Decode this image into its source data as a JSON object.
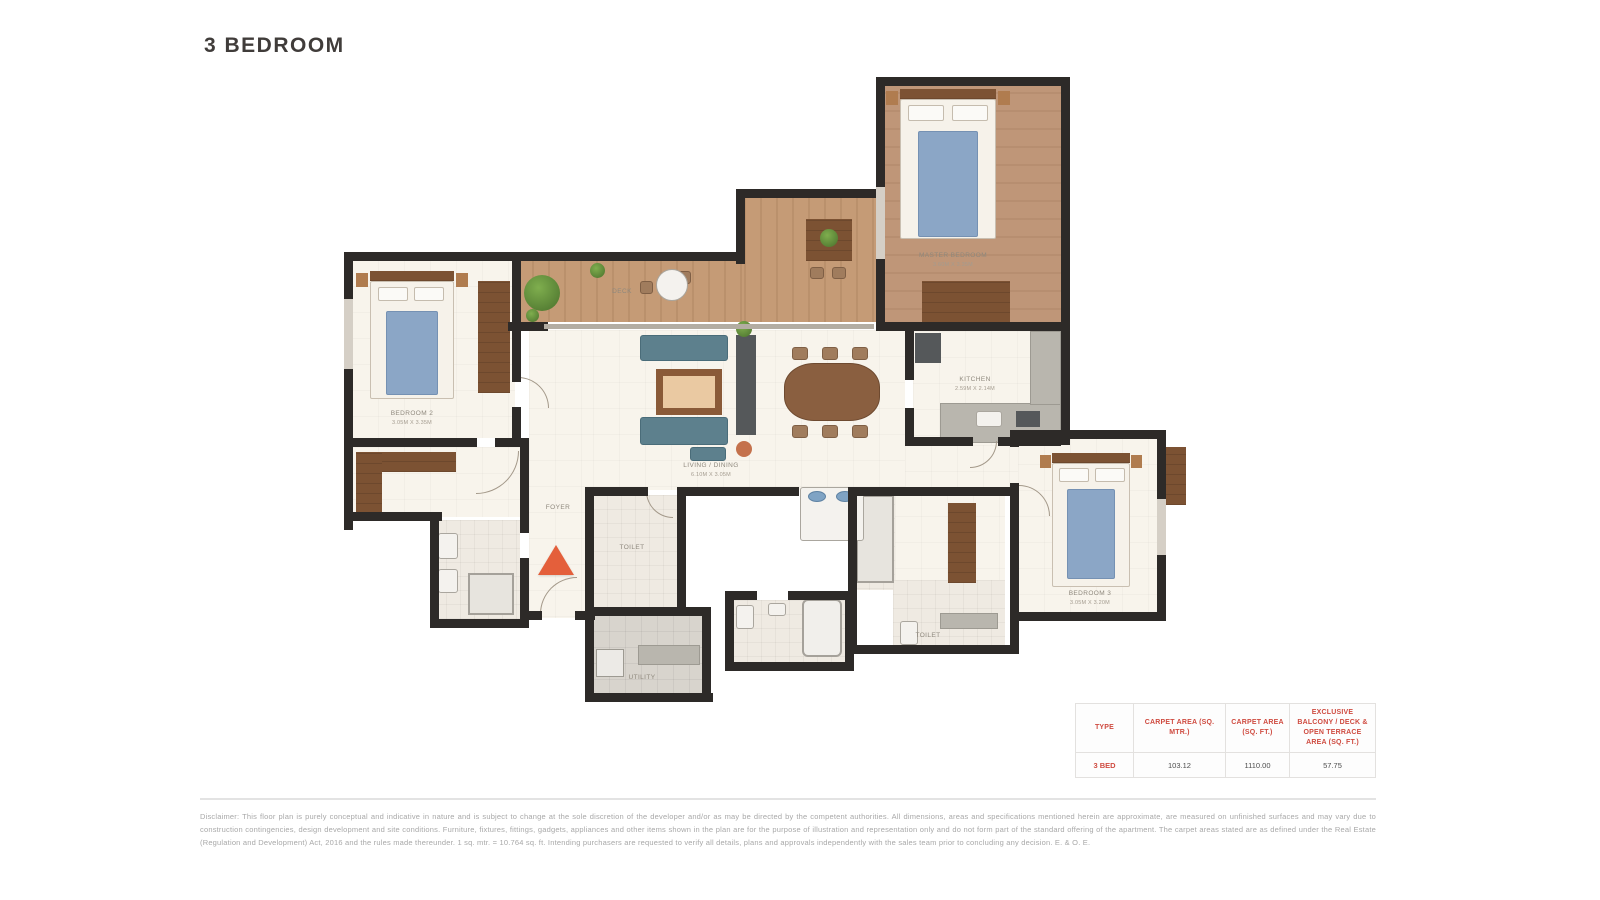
{
  "page": {
    "title": "3 BEDROOM"
  },
  "plan": {
    "rooms": [
      {
        "name": "MASTER BEDROOM",
        "dims": "3.60M X 3.35M"
      },
      {
        "name": "BEDROOM 2",
        "dims": "3.05M X 3.35M"
      },
      {
        "name": "BEDROOM 3",
        "dims": "3.05M X 3.20M"
      },
      {
        "name": "LIVING / DINING",
        "dims": "6.10M X 3.05M"
      },
      {
        "name": "KITCHEN",
        "dims": "2.59M X 2.14M"
      },
      {
        "name": "DECK",
        "dims": ""
      },
      {
        "name": "TOILET",
        "dims": ""
      },
      {
        "name": "TOILET",
        "dims": ""
      },
      {
        "name": "UTILITY",
        "dims": ""
      },
      {
        "name": "FOYER",
        "dims": ""
      }
    ]
  },
  "area_table": {
    "headers": [
      "TYPE",
      "CARPET AREA (SQ. MTR.)",
      "CARPET AREA (SQ. FT.)",
      "EXCLUSIVE BALCONY / DECK & OPEN TERRACE AREA (SQ. FT.)"
    ],
    "row": {
      "type": "3 BED",
      "carpet_sqm": "103.12",
      "carpet_sqft": "1110.00",
      "balcony": "57.75"
    }
  },
  "disclaimer": "Disclaimer: This floor plan is purely conceptual and indicative in nature and is subject to change at the sole discretion of the developer and/or as may be directed by the competent authorities. All dimensions, areas and specifications mentioned herein are approximate, are measured on unfinished surfaces and may vary due to construction contingencies, design development and site conditions. Furniture, fixtures, fittings, gadgets, appliances and other items shown in the plan are for the purpose of illustration and representation only and do not form part of the standard offering of the apartment. The carpet areas stated are as defined under the Real Estate (Regulation and Development) Act, 2016 and the rules made thereunder. 1 sq. mtr. = 10.764 sq. ft. Intending purchasers are requested to verify all details, plans and approvals independently with the sales team prior to concluding any decision. E. & O. E.",
  "colors": {
    "accent_red": "#cf4b40",
    "wall": "#2d2a28",
    "wood": "#c59b76",
    "entry_arrow": "#e45f3b"
  }
}
